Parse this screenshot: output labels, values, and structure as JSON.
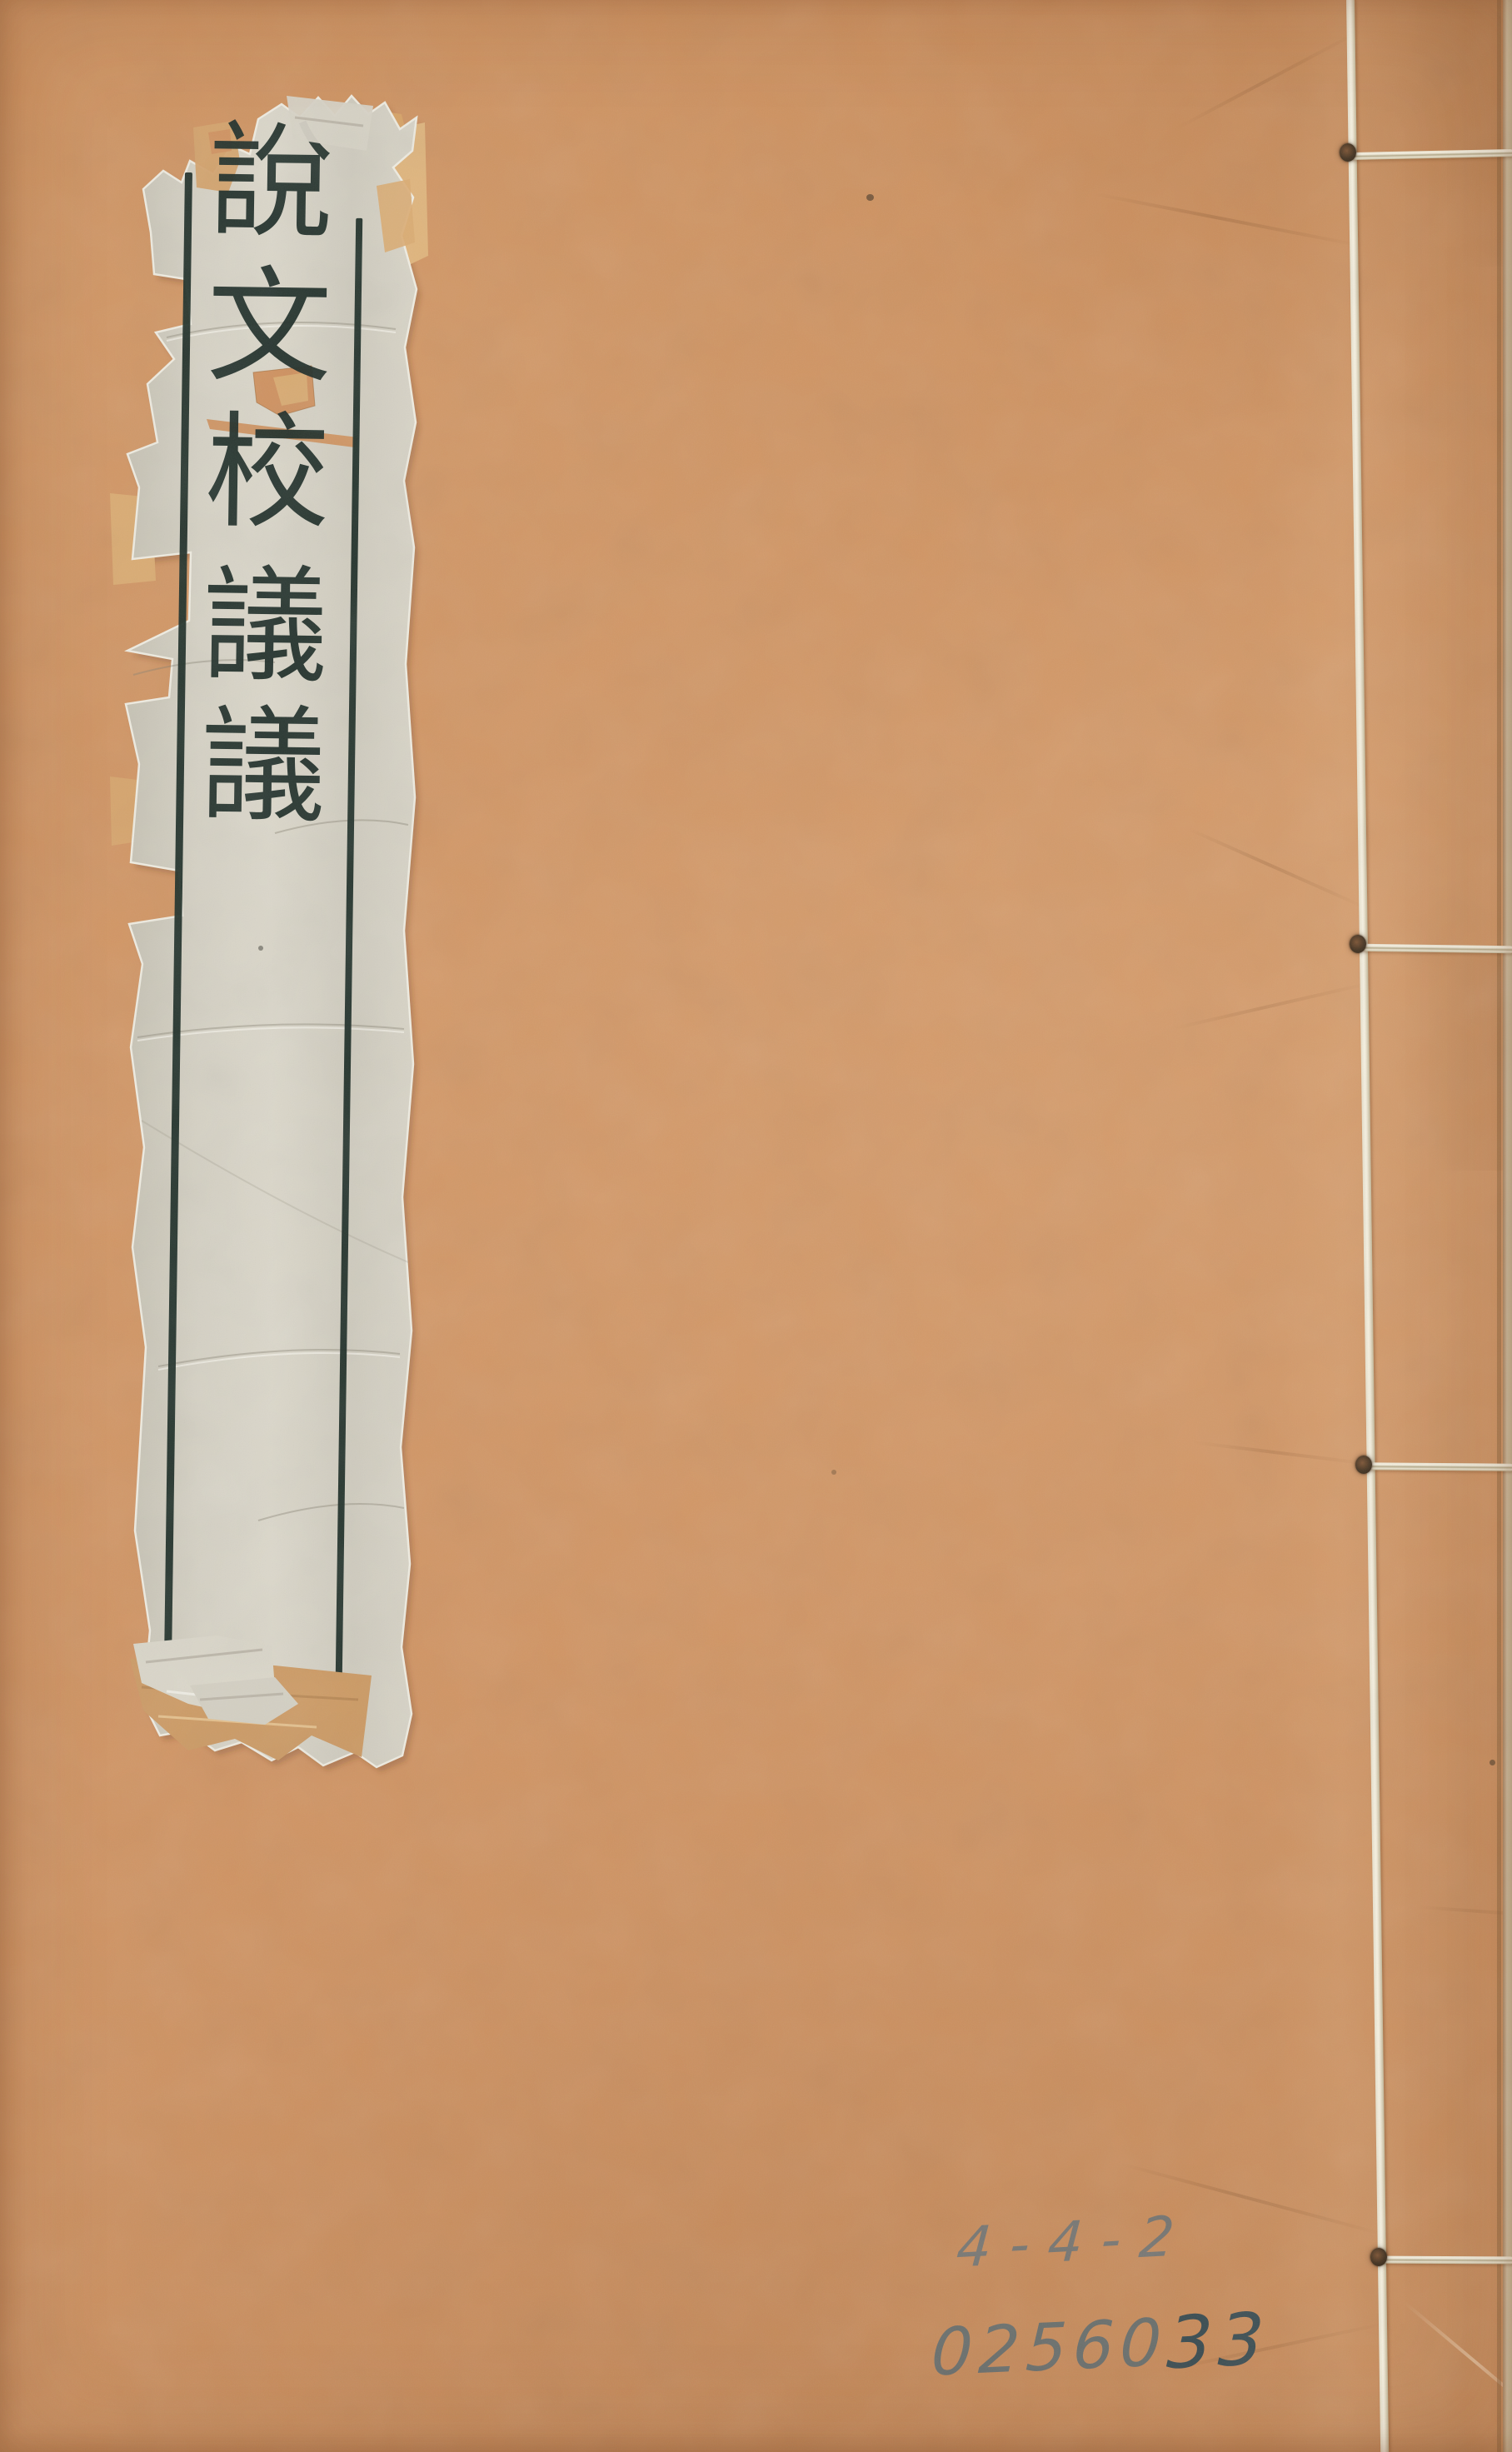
{
  "page": {
    "description": "Front cover of a traditional Chinese four-hole stitch-bound volume with a torn paper title slip"
  },
  "title_label": {
    "title": "說文校議議",
    "characters": [
      "說",
      "文",
      "校",
      "議",
      "議"
    ]
  },
  "handwriting": {
    "shelf_mark": "4-4-2",
    "accession_number": "0256033",
    "accession_light_part": "02560",
    "accession_dark_part": "33"
  },
  "binding": {
    "stitch_count": 4
  },
  "colors": {
    "cover": "#cf9261",
    "label_paper": "#d7d3c6",
    "ink": "#203029",
    "thread": "#f0ead9",
    "tape": "#d7a265",
    "pencil": "#64767c"
  }
}
